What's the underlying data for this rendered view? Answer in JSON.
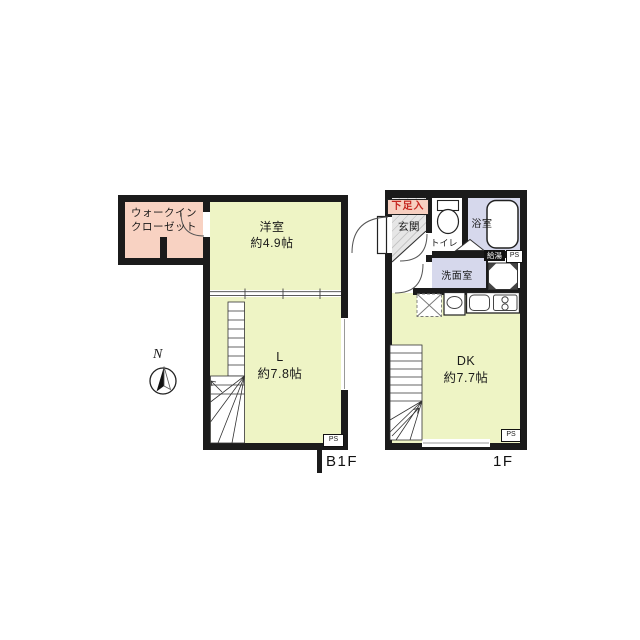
{
  "b1f": {
    "floor_label": "B1F",
    "walk_in_closet": {
      "line1": "ウォークイン",
      "line2": "クローゼット"
    },
    "western_room": {
      "name": "洋室",
      "size": "約4.9帖"
    },
    "living": {
      "name": "L",
      "size": "約7.8帖"
    },
    "ps": "PS"
  },
  "f1": {
    "floor_label": "1F",
    "shoe_box": "下足入",
    "entrance": "玄関",
    "toilet": "トイレ",
    "bathroom": "浴室",
    "washroom": "洗面室",
    "water_heater": "給湯",
    "ps_upper": "PS",
    "ps_lower": "PS",
    "dk": {
      "name": "DK",
      "size": "約7.7帖"
    }
  },
  "compass": {
    "north": "N"
  },
  "colors": {
    "wall": "#1b1b1b",
    "room_green": "#eef4c5",
    "closet_pink": "#f8d2c2",
    "wet_area_lavender": "#d6d8ec",
    "entrance_gray": "#e6e6e6",
    "shoe_box_red": "#c5261f"
  }
}
